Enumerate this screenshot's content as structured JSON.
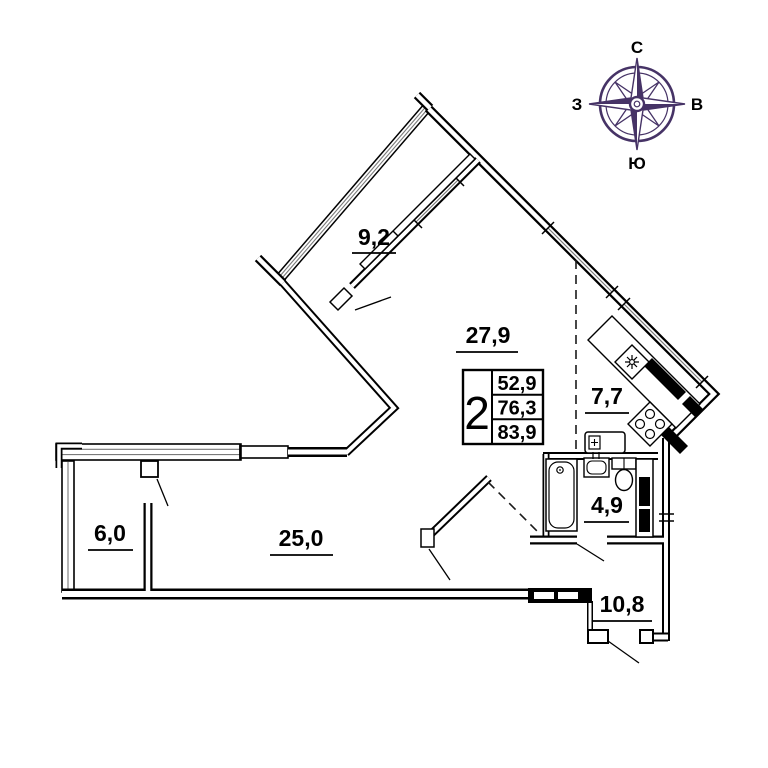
{
  "compass": {
    "north_label": "С",
    "east_label": "В",
    "south_label": "Ю",
    "west_label": "З"
  },
  "apartment_info": {
    "rooms_count": "2",
    "areas": [
      "52,9",
      "76,3",
      "83,9"
    ]
  },
  "rooms": {
    "balcony": {
      "area_label": "9,2"
    },
    "living_room": {
      "area_label": "27,9"
    },
    "kitchen": {
      "area_label": "7,7"
    },
    "bathroom": {
      "area_label": "4,9"
    },
    "loggia": {
      "area_label": "6,0"
    },
    "bedroom": {
      "area_label": "25,0"
    },
    "hallway": {
      "area_label": "10,8"
    }
  },
  "colors": {
    "wall": "#000000",
    "compass_accent": "#463366",
    "glazing": "#7a7a7a"
  }
}
